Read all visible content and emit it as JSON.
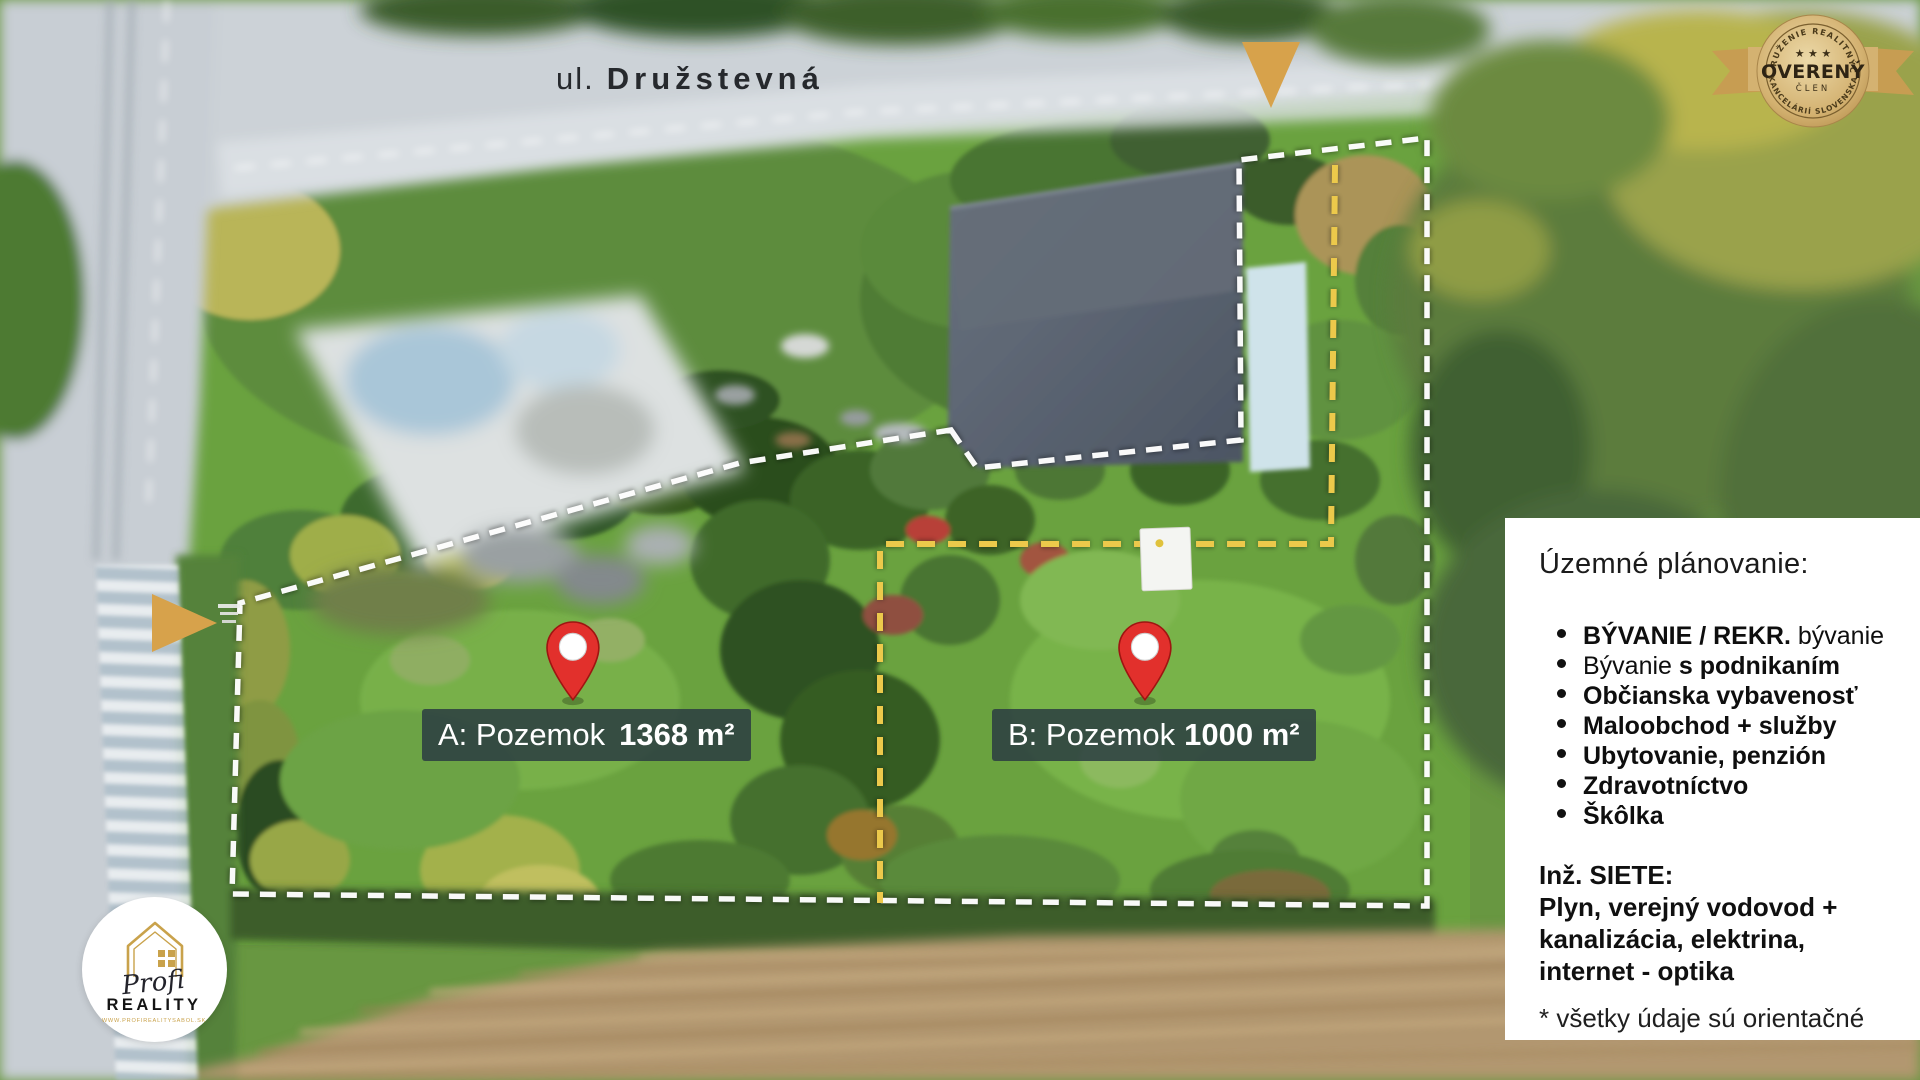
{
  "street": {
    "prefix": "ul.",
    "name": "Družstevná"
  },
  "parcels": [
    {
      "name": "A: Pozemok",
      "area": "1368 m²"
    },
    {
      "name": "B: Pozemok",
      "area": "1000 m²"
    }
  ],
  "panel": {
    "title": "Územné plánovanie:",
    "items": [
      {
        "bold": "BÝVANIE / REKR.",
        "rest": " bývanie"
      },
      {
        "rest": "Bývanie ",
        "bold": "s podnikaním"
      },
      {
        "bold": "Občianska vybavenosť",
        "rest": ""
      },
      {
        "bold": "Maloobchod + služby",
        "rest": ""
      },
      {
        "bold": "Ubytovanie, penzión",
        "rest": ""
      },
      {
        "bold": "Zdravotníctvo",
        "rest": ""
      },
      {
        "bold": "Škôlka",
        "rest": ""
      }
    ],
    "siete_title": "Inž. SIETE:",
    "siete_lines": [
      "Plyn, verejný vodovod +",
      "kanalizácia, elektrina,",
      "internet - optika"
    ],
    "footnote": "* všetky údaje sú orientačné"
  },
  "badge": {
    "arc_top": "ZDRUŽENIE REALITNÝCH",
    "stars": "★ ★ ★",
    "title": "OVERENÝ",
    "subtitle": "ČLEN",
    "arc_bottom": "KANCELÁRIÍ SLOVENSKA"
  },
  "logo": {
    "script": "Profi",
    "name": "REALITY",
    "url": "WWW.PROFIREALITYSABOL.SK"
  },
  "colors": {
    "gold_marker": "#d7a24b",
    "dash_white": "#ffffff",
    "dash_yellow": "#ecc94b",
    "label_bg": "#2a3a42",
    "panel_bg": "#ffffff",
    "pin_red": "#e2302c"
  }
}
